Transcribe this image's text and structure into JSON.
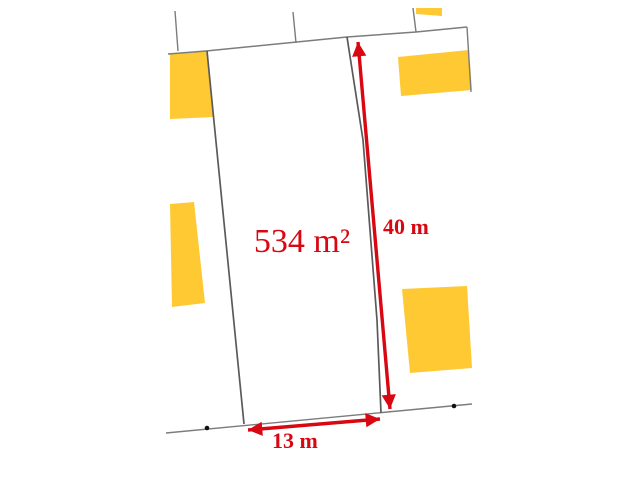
{
  "labels": {
    "area": "534 m²",
    "depth": "40 m",
    "frontage": "13 m"
  },
  "measurements": {
    "area_m2": 534,
    "depth_m": 40,
    "frontage_m": 13
  },
  "colors": {
    "red": "#d90712",
    "building_fill": "#fec933",
    "boundary": "#7c7c7c",
    "parcel_line": "#5a5a5a",
    "point": "#111111",
    "background": "#ffffff"
  },
  "features": [
    {
      "name": "building-top-sliver",
      "type": "polygon",
      "fill": "building_fill",
      "points": [
        [
          416,
          8
        ],
        [
          442,
          8
        ],
        [
          442,
          16
        ],
        [
          416,
          14
        ]
      ]
    },
    {
      "name": "building-top-left",
      "type": "polygon",
      "fill": "building_fill",
      "points": [
        [
          170,
          54
        ],
        [
          206,
          51
        ],
        [
          214,
          117
        ],
        [
          170,
          119
        ]
      ]
    },
    {
      "name": "building-mid-left",
      "type": "polygon",
      "fill": "building_fill",
      "points": [
        [
          170,
          204
        ],
        [
          194,
          202
        ],
        [
          205,
          303
        ],
        [
          172,
          307
        ]
      ]
    },
    {
      "name": "building-top-right",
      "type": "polygon",
      "fill": "building_fill",
      "points": [
        [
          398,
          57
        ],
        [
          469,
          50
        ],
        [
          472,
          90
        ],
        [
          401,
          96
        ]
      ]
    },
    {
      "name": "building-bottom-right",
      "type": "polygon",
      "fill": "building_fill",
      "points": [
        [
          402,
          289
        ],
        [
          467,
          286
        ],
        [
          472,
          368
        ],
        [
          410,
          373
        ]
      ]
    },
    {
      "name": "boundary-stub-west",
      "type": "polyline",
      "stroke": "boundary",
      "width": 1.4,
      "points": [
        [
          175,
          11
        ],
        [
          178,
          51
        ]
      ]
    },
    {
      "name": "boundary-stub-middle",
      "type": "polyline",
      "stroke": "boundary",
      "width": 1.4,
      "points": [
        [
          293,
          12
        ],
        [
          296,
          43
        ]
      ]
    },
    {
      "name": "boundary-stub-east",
      "type": "polyline",
      "stroke": "boundary",
      "width": 1.4,
      "points": [
        [
          413,
          8
        ],
        [
          416,
          32
        ]
      ]
    },
    {
      "name": "boundary-top",
      "type": "polyline",
      "stroke": "boundary",
      "width": 1.5,
      "points": [
        [
          168,
          54
        ],
        [
          206,
          51
        ],
        [
          347,
          37
        ],
        [
          416,
          32
        ],
        [
          467,
          27
        ]
      ]
    },
    {
      "name": "boundary-right",
      "type": "polyline",
      "stroke": "boundary",
      "width": 1.4,
      "points": [
        [
          467,
          27
        ],
        [
          471,
          92
        ]
      ]
    },
    {
      "name": "boundary-bottom-road",
      "type": "polyline",
      "stroke": "boundary",
      "width": 1.4,
      "points": [
        [
          166,
          433
        ],
        [
          472,
          404
        ]
      ]
    },
    {
      "name": "parcel-west-boundary",
      "type": "polyline",
      "stroke": "parcel_line",
      "width": 1.7,
      "points": [
        [
          207,
          51
        ],
        [
          244,
          424
        ]
      ]
    },
    {
      "name": "parcel-east-boundary",
      "type": "polyline",
      "stroke": "parcel_line",
      "width": 1.7,
      "points": [
        [
          347,
          37
        ],
        [
          363,
          140
        ],
        [
          377,
          320
        ],
        [
          381,
          413
        ]
      ]
    },
    {
      "name": "survey-point-west",
      "type": "circle",
      "fill": "point",
      "cx": 207,
      "cy": 428,
      "r": 2.3
    },
    {
      "name": "survey-point-east",
      "type": "circle",
      "fill": "point",
      "cx": 454,
      "cy": 406,
      "r": 2.3
    },
    {
      "name": "dimension-arrow-depth",
      "type": "arrow",
      "points": [
        [
          358,
          42
        ],
        [
          390,
          409
        ]
      ]
    },
    {
      "name": "dimension-arrow-frontage",
      "type": "arrow",
      "points": [
        [
          248,
          430
        ],
        [
          380,
          419
        ]
      ]
    }
  ]
}
